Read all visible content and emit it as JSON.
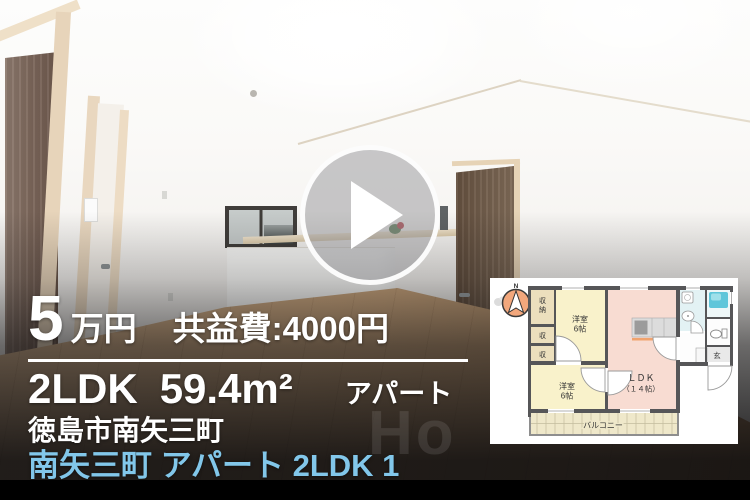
{
  "listing": {
    "price_value": "5",
    "price_unit": "万円",
    "management_fee": "共益費:4000円",
    "layout": "2LDK",
    "area": "59.4m²",
    "building_type": "アパート",
    "address": "徳島市南矢三町",
    "title": "南矢三町 アパート 2LDK 1"
  },
  "watermark": "Ho",
  "floorplan": {
    "compass": "N",
    "labels": {
      "closet_big_1": "収",
      "closet_big_2": "納",
      "closet_1": "収",
      "closet_2": "収",
      "west_room_1_name": "洋室",
      "west_room_1_size": "6帖",
      "west_room_2_name": "洋室",
      "west_room_2_size": "6帖",
      "ldk_name": "ＬＤＫ",
      "ldk_size": "（１４帖）",
      "entrance": "玄",
      "balcony": "バルコニー"
    }
  },
  "colors": {
    "title_link_blue": "#82c7ea",
    "overlay_text": "#ffffff",
    "bottom_bar": "#000000",
    "fp_west_room": "#f9f2cb",
    "fp_ldk": "#f8dcd2",
    "fp_closet": "#ecdfbd",
    "fp_bath": "#5fc6da",
    "fp_balcony": "#efe8ca",
    "fp_wall": "#565658"
  }
}
